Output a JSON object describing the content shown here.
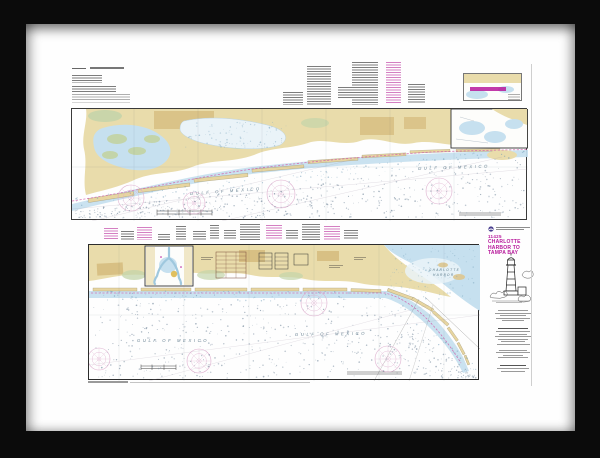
{
  "artwork": {
    "kind": "Framed nautical chart print, black frame with white mat",
    "chart_number": "11425",
    "chart_title_lines": [
      "CHARLOTTE",
      "HARBOR TO",
      "TAMPA BAY"
    ],
    "labels": {
      "gulf_upper_left": "GULF OF MEXICO",
      "gulf_upper_right": "GULF OF MEXICO",
      "gulf_lower_left": "GULF OF MEXICO",
      "gulf_lower_mid": "GULF OF MEXICO",
      "charlotte_harbor_line1": "CHARLOTTE",
      "charlotte_harbor_line2": "HARBOR"
    }
  },
  "colors": {
    "frame": "#0b0b0b",
    "mat": "#fefefe",
    "land": "#e9dcab",
    "land_dark": "#d8c084",
    "island": "#e7d5a0",
    "marsh": "#c3d4a9",
    "water": "#c6e0ef",
    "water_deep": "#9fc8de",
    "lagoon_pale": "#eaf3f8",
    "magenta": "#b7179b",
    "icw": "#d263ab",
    "rose_pink": "#dcaacb",
    "sea_text": "#6b8494",
    "ink": "#2f2f2f",
    "dot": "#7d90a2"
  }
}
